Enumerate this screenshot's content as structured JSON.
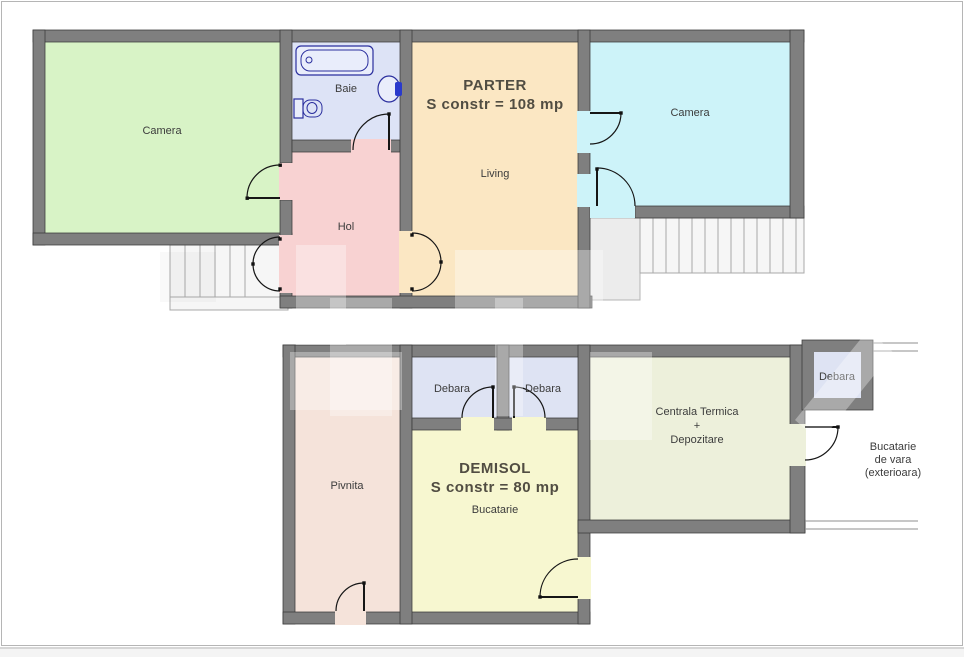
{
  "parter": {
    "title": "PARTER",
    "area": "S constr = 108 mp",
    "rooms": {
      "camera_left": "Camera",
      "baie": "Baie",
      "hol": "Hol",
      "living": "Living",
      "camera_right": "Camera"
    }
  },
  "demisol": {
    "title": "DEMISOL",
    "area": "S constr = 80 mp",
    "rooms": {
      "pivnita": "Pivnita",
      "debara_left": "Debara",
      "debara_right": "Debara",
      "bucatarie": "Bucatarie",
      "centrala": {
        "line1": "Centrala Termica",
        "line2": "+",
        "line3": "Depozitare"
      },
      "debara_exterior": "Debara",
      "bucatarie_vara": {
        "line1": "Bucatarie",
        "line2": "de vara",
        "line3": "(exterioara)"
      }
    }
  },
  "palette": {
    "wall": "#7f7f7f",
    "camera_green": "#d8f3c6",
    "baie_blue": "#dde3f6",
    "hol_pink": "#f8d2d2",
    "living_tan": "#fbe7c3",
    "camera_cyan": "#cdf3f9",
    "pivnita_rose": "#f5e3da",
    "debara_lavender": "#dee3f3",
    "bucatarie_yellow": "#f7f7d0",
    "centrala_sage": "#edf0db"
  }
}
